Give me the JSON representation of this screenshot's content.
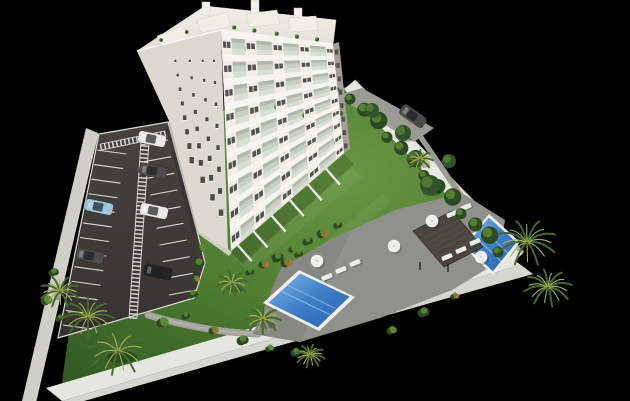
{
  "meta": {
    "title": "Aerial 3D architectural render of a white multi-storey apartment building with balconies, a walled site, parking lot with cars, landscaped gardens, sun deck with pergola and two swimming pools, on a black background"
  },
  "colors": {
    "background": "#000000",
    "building_front": "#f2efe8",
    "building_side": "#ddd9d0",
    "slab": "#f7f5ef",
    "glass": "#c8cfc3",
    "window": "#3c3f3b",
    "plant_dark": "#3c5a28",
    "plant_light": "#6e9440",
    "lawn_light": "#6a9644",
    "lawn_mid": "#4f7d31",
    "lawn_dark": "#2e5621",
    "asphalt": "#3e3b37",
    "line_white": "#e9e9e4",
    "wall_top": "#e8e8e3",
    "wall_side": "#cfcfc8",
    "path": "#9a9c93",
    "deck": "#8f918a",
    "pool_rim": "#eef0ec",
    "water_light": "#7fb7e8",
    "water_mid": "#3f7ec7",
    "water_dark": "#2a63ad",
    "pergola": "#45403a",
    "white": "#eceee9",
    "trunk": "#6b5436",
    "shrub_orange": "#b0702e",
    "hedge_dark": "#2c4a22",
    "hedge_light": "#5d8636",
    "frond_dark": "#47682e",
    "frond_light": "#9fb254",
    "car_white": "#e8e8e6",
    "car_gray": "#4b4b49",
    "car_black": "#242424",
    "car_blue": "#9fc6dd"
  },
  "scene": {
    "building": {
      "floors": 9,
      "sw": {
        "T0": [
          137,
          51
        ],
        "T1": [
          221,
          30
        ],
        "B0": [
          170,
          123
        ],
        "B1": [
          228,
          250
        ],
        "rows": 8,
        "cols": [
          0.42,
          0.6,
          0.76,
          0.9
        ]
      },
      "se": {
        "T0": [
          221,
          30
        ],
        "T1": [
          333,
          44
        ],
        "B0": [
          231,
          251
        ],
        "B1": [
          344,
          153
        ],
        "piers": [
          [
            0,
            0.09
          ],
          [
            0.21,
            0.31
          ],
          [
            0.45,
            0.55
          ],
          [
            0.69,
            0.79
          ],
          [
            0.93,
            1
          ]
        ],
        "bays": [
          [
            0.09,
            0.21
          ],
          [
            0.31,
            0.45
          ],
          [
            0.55,
            0.69
          ],
          [
            0.79,
            0.93
          ]
        ],
        "roof_plants": [
          0.12,
          0.3,
          0.5,
          0.68,
          0.86
        ]
      },
      "ne_notches": 8
    },
    "parking": {
      "left_edge": [
        [
          97,
          150
        ],
        [
          63,
          325
        ]
      ],
      "left_count": 12,
      "left_dir": [
        29,
        4
      ],
      "right_edge": [
        [
          168,
          140
        ],
        [
          196,
          290
        ]
      ],
      "right_count": 9,
      "right_dir": [
        -27,
        5
      ],
      "walkway": {
        "from": [
          145,
          142
        ],
        "to": [
          133,
          318
        ],
        "width": 8
      },
      "crosswalk": {
        "from": [
          101,
          147
        ],
        "to": [
          165,
          134
        ],
        "width": 6
      },
      "cars": [
        {
          "pos": [
            152,
            139
          ],
          "rot": 12,
          "color": "white"
        },
        {
          "pos": [
            153,
            171
          ],
          "rot": 12,
          "color": "gray"
        },
        {
          "pos": [
            154,
            211
          ],
          "rot": 12,
          "color": "white"
        },
        {
          "pos": [
            158,
            272
          ],
          "rot": 12,
          "color": "black"
        },
        {
          "pos": [
            99,
            207
          ],
          "rot": 12,
          "color": "blue"
        },
        {
          "pos": [
            90,
            256
          ],
          "rot": 12,
          "color": "gray"
        },
        {
          "pos": [
            413,
            116
          ],
          "rot": 35,
          "color": "gray"
        }
      ]
    },
    "pool_area": {
      "pergola": [
        [
          413,
          231
        ],
        [
          452,
          211
        ],
        [
          483,
          247
        ],
        [
          444,
          267
        ]
      ],
      "loungers": [
        [
          327,
          277
        ],
        [
          341,
          270
        ],
        [
          355,
          263
        ],
        [
          447,
          257
        ],
        [
          461,
          250
        ],
        [
          475,
          242
        ],
        [
          452,
          214
        ],
        [
          466,
          207
        ]
      ],
      "umbrellas": [
        [
          317,
          261
        ],
        [
          394,
          246
        ],
        [
          432,
          221
        ],
        [
          481,
          257
        ]
      ]
    },
    "vegetation": {
      "hedge": {
        "from": [
          352,
          97
        ],
        "to": [
          500,
          250
        ],
        "count": 13
      },
      "trees": [
        [
          372,
          110,
          7
        ],
        [
          403,
          133,
          8
        ],
        [
          430,
          185,
          10
        ],
        [
          449,
          161,
          7
        ]
      ],
      "palms": [
        [
          88,
          318,
          26
        ],
        [
          118,
          352,
          30
        ],
        [
          60,
          292,
          20
        ],
        [
          232,
          284,
          16
        ],
        [
          263,
          320,
          18
        ],
        [
          310,
          356,
          15
        ],
        [
          527,
          243,
          30
        ],
        [
          548,
          288,
          24
        ],
        [
          420,
          160,
          13
        ]
      ],
      "shrubs": [
        [
          250,
          272
        ],
        [
          264,
          264
        ],
        [
          278,
          257
        ],
        [
          293,
          249
        ],
        [
          308,
          241
        ],
        [
          323,
          233
        ],
        [
          338,
          225
        ],
        [
          202,
          248
        ],
        [
          199,
          263
        ],
        [
          196,
          279
        ],
        [
          193,
          294
        ],
        [
          163,
          322
        ],
        [
          186,
          316
        ],
        [
          214,
          330
        ],
        [
          243,
          340
        ],
        [
          270,
          348
        ],
        [
          296,
          352
        ],
        [
          287,
          262
        ],
        [
          299,
          254
        ],
        [
          392,
          330
        ],
        [
          424,
          312
        ],
        [
          455,
          296
        ],
        [
          54,
          272
        ],
        [
          47,
          300
        ],
        [
          60,
          318
        ]
      ],
      "terrace_walls": [
        0.06,
        0.2,
        0.36,
        0.52,
        0.68,
        0.84
      ]
    }
  }
}
